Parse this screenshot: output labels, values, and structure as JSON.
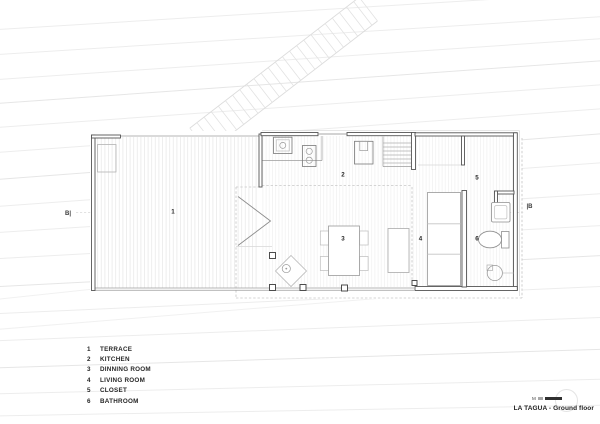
{
  "plan": {
    "rooms": [
      {
        "number": "1",
        "label": "TERRACE"
      },
      {
        "number": "2",
        "label": "KITCHEN"
      },
      {
        "number": "3",
        "label": "DINNING ROOM"
      },
      {
        "number": "4",
        "label": "LIVING ROOM"
      },
      {
        "number": "5",
        "label": "CLOSET"
      },
      {
        "number": "6",
        "label": "BATHROOM"
      }
    ],
    "section_markers": {
      "left": "B|",
      "right": "|B"
    }
  },
  "titleblock": {
    "title": "LA TAGUA - Ground floor",
    "scale_unit": "M"
  },
  "colors": {
    "paper": "#ffffff",
    "wall_line": "#555555",
    "furniture_line": "#9a9a9a",
    "contour_line": "#ededed",
    "dashed_line": "#c7c7c7",
    "text": "#262626"
  }
}
